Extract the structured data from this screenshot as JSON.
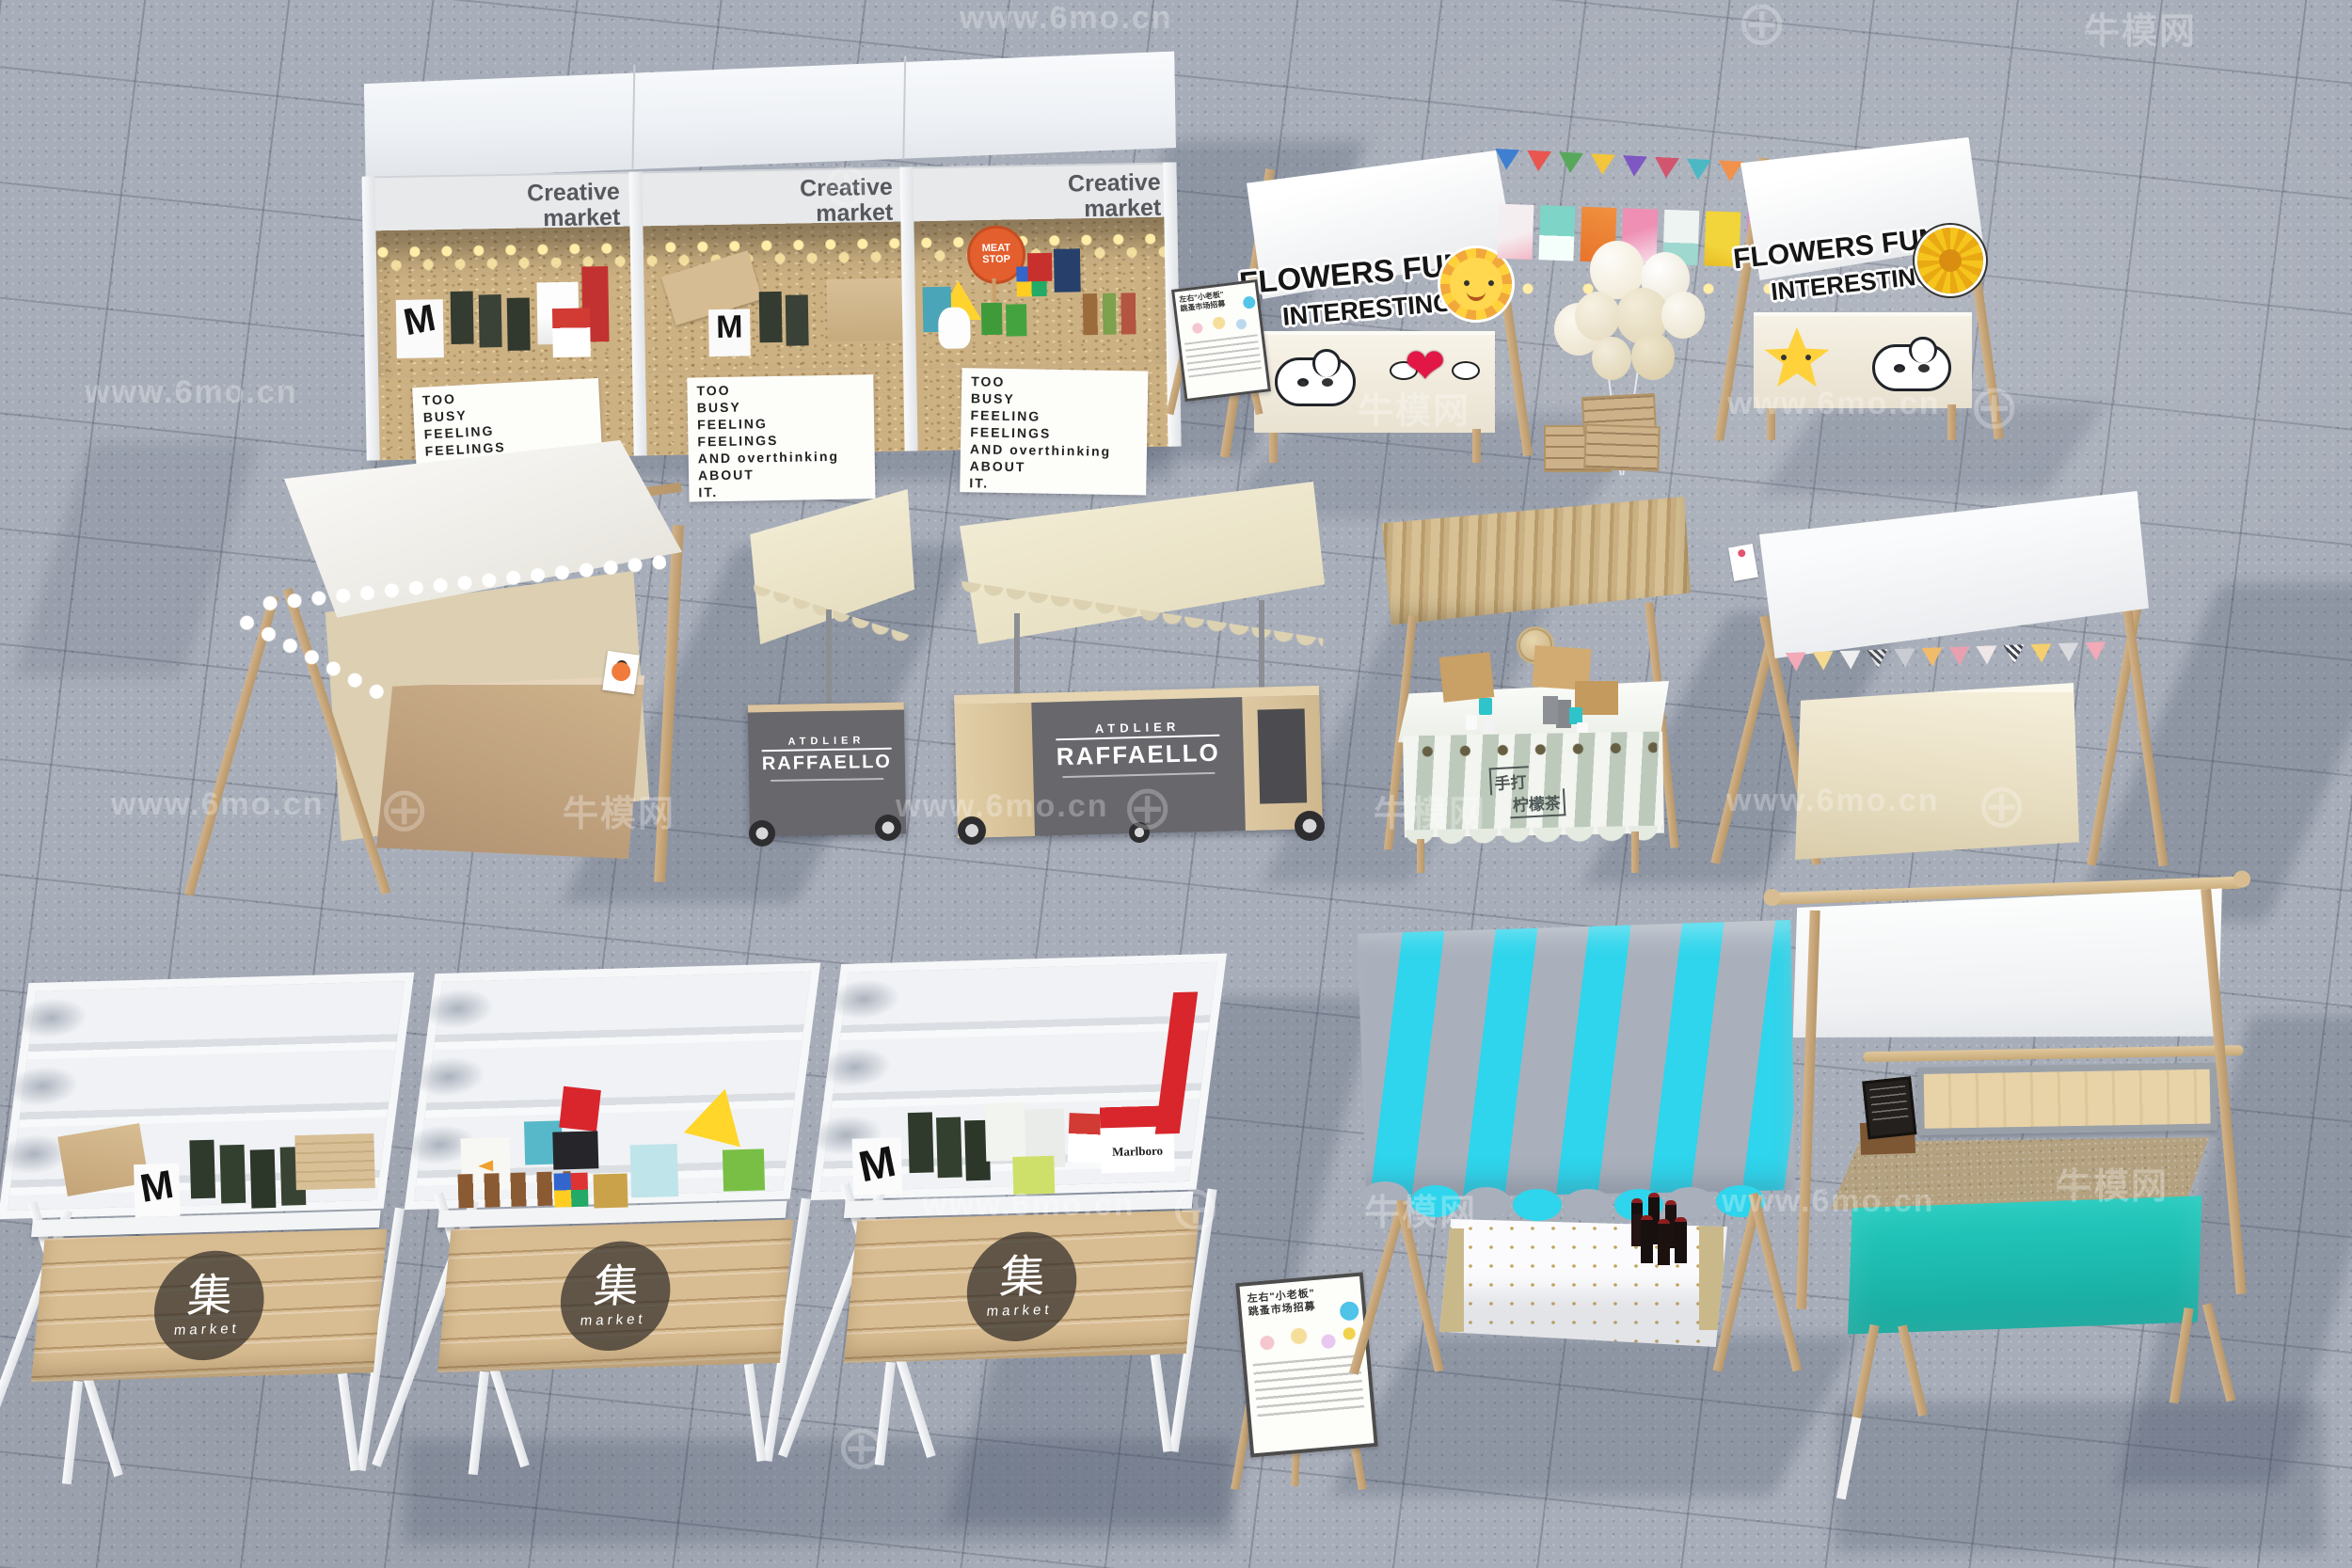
{
  "watermark": {
    "site": "www.6mo.cn",
    "brand": "牛模网",
    "logo_glyph": "⊕"
  },
  "creative_market": {
    "header": "Creative market",
    "sign": "TOO\nBUSY\nFEELING\nFEELINGS\nAND overthinking\nABOUT\nIT.",
    "meat_stop": "MEAT\nSTOP"
  },
  "flowers_stall": {
    "badge_line1": "FLOWERS FUN",
    "badge_line2": "INTERESTING"
  },
  "atelier_cart": {
    "brand_top": "ATDLIER",
    "brand_main": "RAFFAELLO"
  },
  "lemon_tea_stall": {
    "plaque_line1": "手打",
    "plaque_line2": "柠檬茶"
  },
  "ji_market": {
    "logo_char": "集",
    "logo_sub": "market",
    "marlboro": "Marlboro",
    "m_mark": "M"
  },
  "easel_poster": {
    "title_line1": "左右\"小老板\"",
    "title_line2": "跳蚤市场招募"
  },
  "colors": {
    "floor": "#a8aeb9",
    "cyan_stripe": "#2ed5ec",
    "awning_gray": "#a9b0bc",
    "teal_skirt": "#1fc8bd",
    "awning_cream": "#efe8d0",
    "wood_light": "#d9bd92",
    "cart_gray": "#67676c",
    "osb": "#ccb183",
    "stripe_green": "#bcc9bb",
    "badge_dark": "rgba(48,44,40,0.72)"
  }
}
